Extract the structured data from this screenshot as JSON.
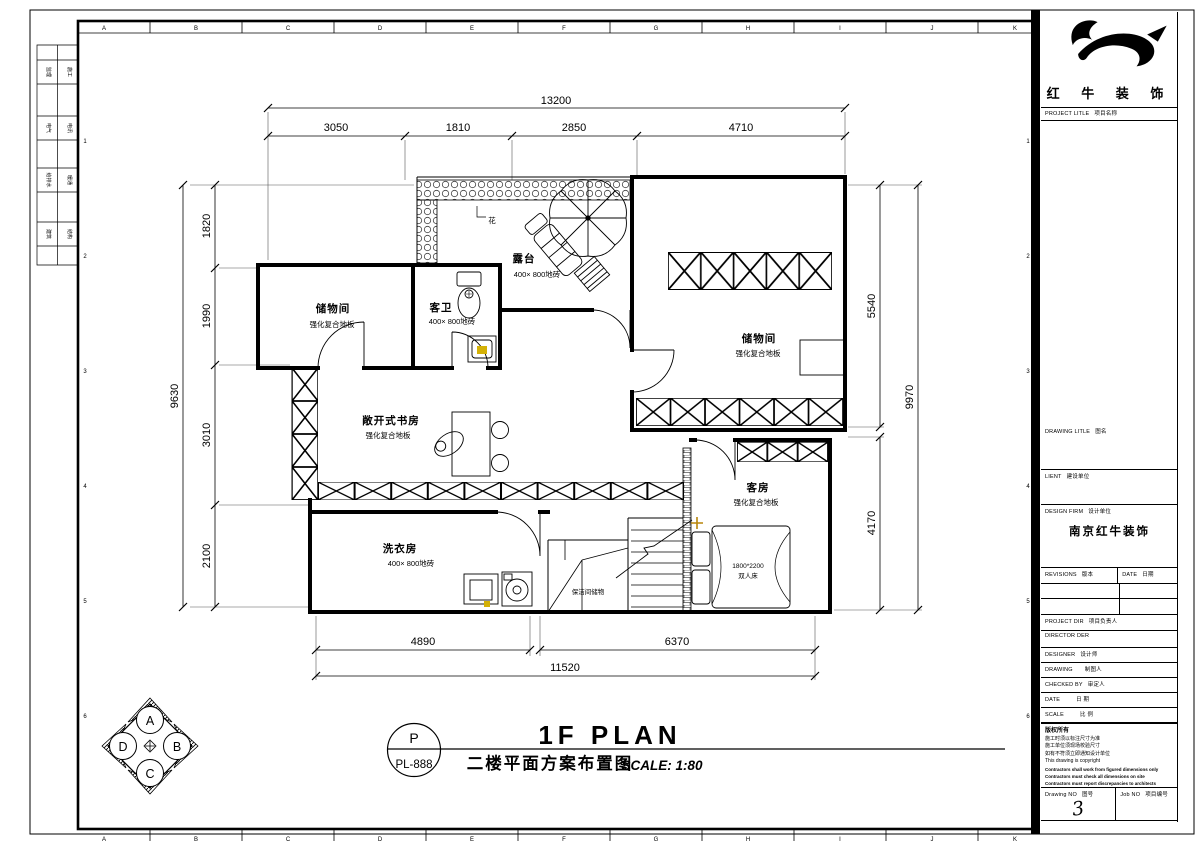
{
  "sheet": {
    "grid_letters_top": [
      "A",
      "B",
      "C",
      "D",
      "E",
      "F",
      "G",
      "H",
      "I",
      "J",
      "K"
    ],
    "grid_letters_bottom": [
      "A",
      "B",
      "C",
      "D",
      "E",
      "F",
      "G",
      "H",
      "I",
      "J",
      "K"
    ],
    "row_numbers": [
      "1",
      "2",
      "3",
      "4",
      "5",
      "6"
    ],
    "margin_rows": [
      {
        "left": "监理",
        "right": "施工"
      },
      {
        "left": "电气",
        "right": "电讯"
      },
      {
        "left": "给排水",
        "right": "暖通"
      },
      {
        "left": "建筑",
        "right": "结构"
      }
    ]
  },
  "dims": {
    "top_total": "13200",
    "top": [
      "3050",
      "1810",
      "2850",
      "4710"
    ],
    "left_total": "9630",
    "left": [
      "1820",
      "1990",
      "3010",
      "2100"
    ],
    "right": [
      "5540",
      "4170"
    ],
    "right_total": "9970",
    "bottom": [
      "4890",
      "6370"
    ],
    "bottom_total": "11520"
  },
  "rooms": {
    "storage_left": {
      "name": "储物间",
      "floor": "强化复合地板"
    },
    "guest_bath": {
      "name": "客卫",
      "floor": "400× 800地砖"
    },
    "terrace": {
      "name": "露台",
      "floor": "400× 800地砖"
    },
    "planter": "花",
    "storage_right": {
      "name": "储物间",
      "floor": "强化复合地板"
    },
    "study": {
      "name": "敞开式书房",
      "floor": "强化复合地板"
    },
    "laundry": {
      "name": "洗衣房",
      "floor": "400× 800地砖"
    },
    "guest_room": {
      "name": "客房",
      "floor": "强化复合地板"
    },
    "bed": {
      "size": "1800*2200",
      "type": "双人床"
    },
    "understair": "保洁间储物"
  },
  "titlebar": {
    "bubble_letter": "P",
    "bubble_code": "PL-888",
    "name_en": "1F PLAN",
    "name_cn": "二楼平面方案布置图",
    "scale": "SCALE: 1:80"
  },
  "compass": {
    "top": "A",
    "right": "B",
    "bottom": "C",
    "left": "D"
  },
  "titleblock": {
    "company": "红 牛 装 饰",
    "project_label": "PROJECT LITLE",
    "project_label_cn": "项目名称",
    "drawing_label": "DRAWING LITLE",
    "drawing_label_cn": "图名",
    "client_label": "LIENT",
    "client_label_cn": "建设单位",
    "firm_label": "DESIGN FIRM",
    "firm_label_cn": "设计单位",
    "firm_value": "南京红牛装饰",
    "revisions_label": "REVISIONS",
    "revisions_label_cn": "版本",
    "date_col_label": "DATE",
    "date_col_label_cn": "日期",
    "project_dir_label": "PROJECT DIR",
    "project_dir_label_cn": "项目负责人",
    "director_label": "DIRECTOR DER",
    "designer_label": "DESIGNER",
    "designer_label_cn": "设计师",
    "drawing_by_label": "DRAWING",
    "drawing_by_label_cn": "制图人",
    "checked_label": "CHECKED BY",
    "checked_label_cn": "审定人",
    "date_label": "DATE",
    "date_label_cn": "日 期",
    "scale_label": "SCALE",
    "scale_label_cn": "比 例",
    "copyright_title": "版权所有",
    "copyright_cn_1": "施工时须以标注尺寸为准",
    "copyright_cn_2": "施工单位须现场校验尺寸",
    "copyright_cn_3": "如有不符须立即通知设计单位",
    "copyright_en": "This drawing is copyright",
    "copyright_en_1": "Contractors shall work from figured dimensions only",
    "copyright_en_2": "Contractors must check all dimensions on site",
    "copyright_en_3": "Contractors must report discrepancies to architects",
    "drawing_no_label": "Drawing NO",
    "drawing_no_label_cn": "图号",
    "drawing_no": "3",
    "job_no_label": "Job NO",
    "job_no_label_cn": "项目编号"
  }
}
